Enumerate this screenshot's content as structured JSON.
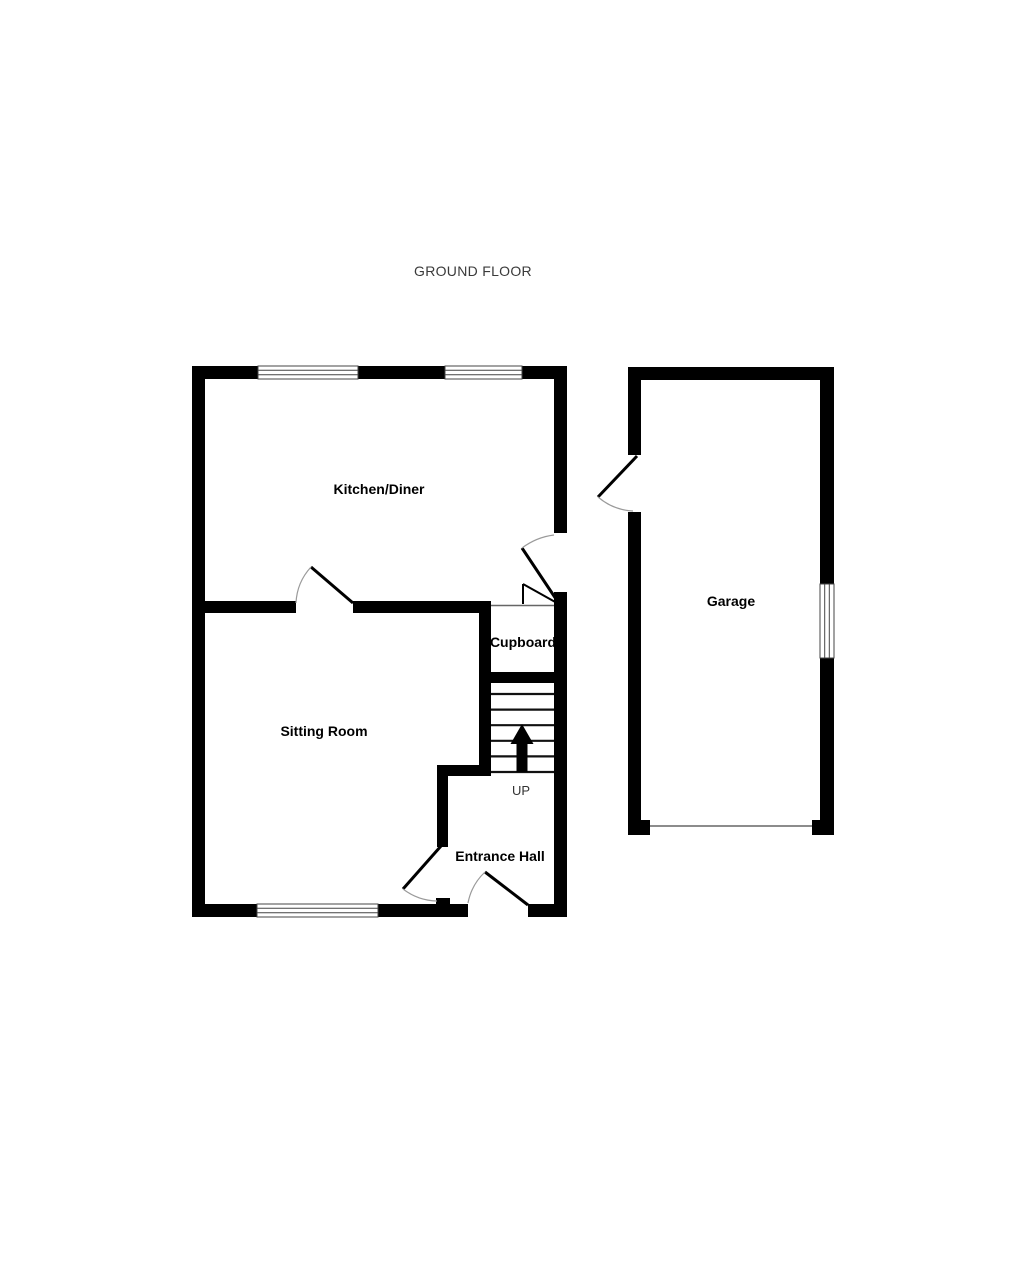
{
  "title": "GROUND FLOOR",
  "rooms": {
    "kitchen_diner": {
      "label": "Kitchen/Diner"
    },
    "sitting_room": {
      "label": "Sitting Room"
    },
    "cupboard": {
      "label": "Cupboard"
    },
    "entrance_hall": {
      "label": "Entrance Hall"
    },
    "garage": {
      "label": "Garage"
    }
  },
  "stairs": {
    "direction": "UP"
  },
  "colors": {
    "background": "#ffffff",
    "wall": "#000000",
    "door_arc": "#9a9a9a",
    "window_outline": "#444444",
    "title_text": "#3a3a3a",
    "label_text": "#000000"
  }
}
